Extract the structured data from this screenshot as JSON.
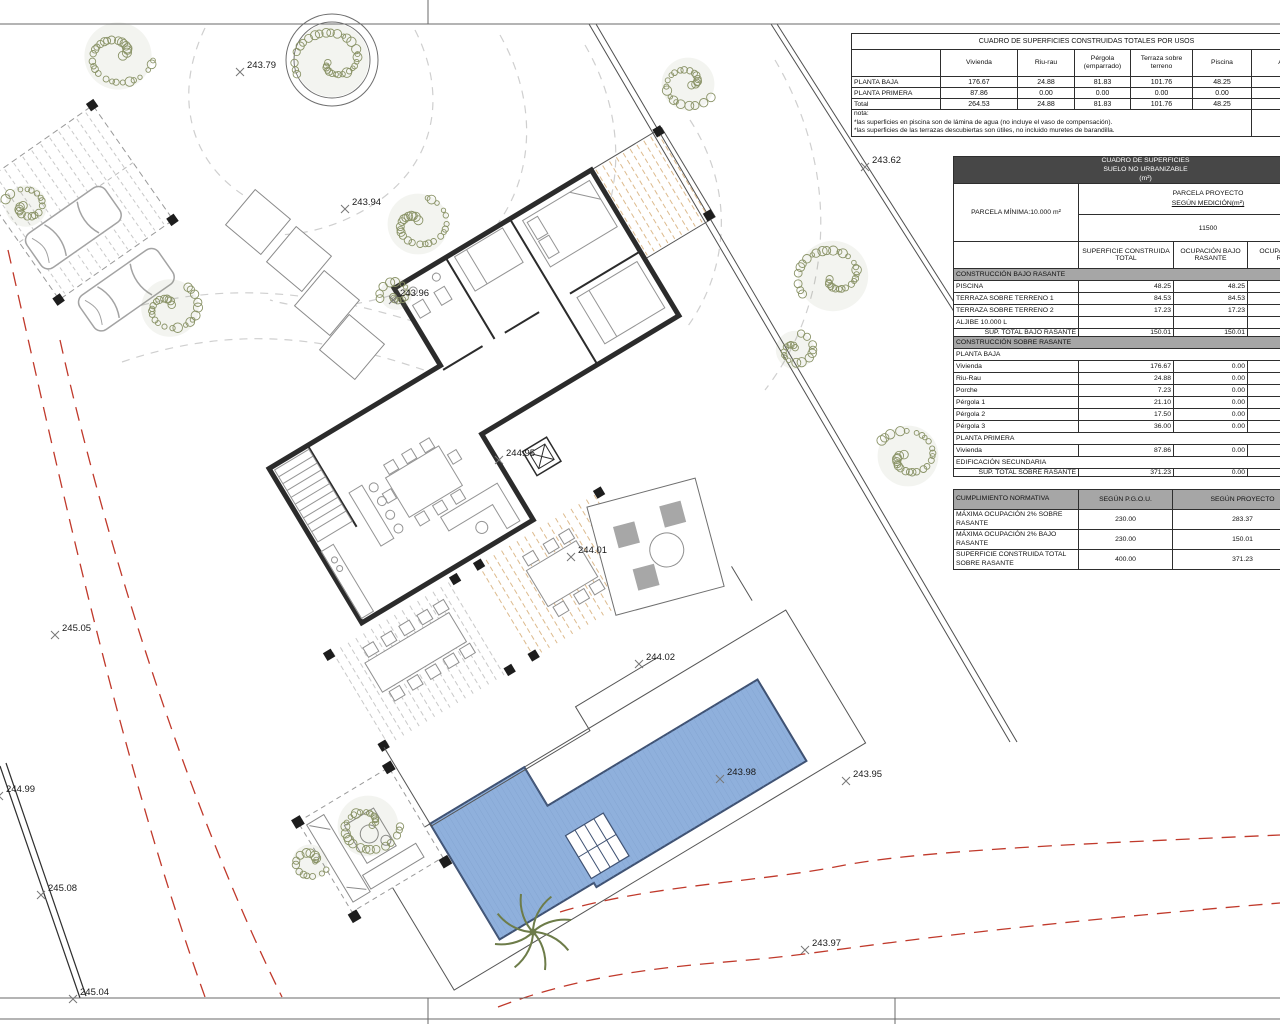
{
  "tables": {
    "usos": {
      "title": "CUADRO DE SUPERFICIES CONSTRUIDAS TOTALES POR USOS",
      "columns": [
        "",
        "Vivienda",
        "Riu-rau",
        "Pérgola (emparrado)",
        "Terraza sobre terreno",
        "Piscina",
        "Aljibe"
      ],
      "rows": [
        [
          "PLANTA BAJA",
          "176.67",
          "24.88",
          "81.83",
          "101.76",
          "48.25",
          "10"
        ],
        [
          "PLANTA PRIMERA",
          "87.86",
          "0.00",
          "0.00",
          "0.00",
          "0.00",
          "0."
        ],
        [
          "Total",
          "264.53",
          "24.88",
          "81.83",
          "101.76",
          "48.25",
          "10"
        ]
      ],
      "note_label": "nota:",
      "notes": [
        "*las superficies en piscina son de lámina de agua (no incluye el vaso de compensación).",
        "*las superficies de las terrazas descubiertas son útiles, no incluido muretes de barandilla."
      ]
    },
    "suelo": {
      "title_lines": [
        "CUADRO DE SUPERFICIES",
        "SUELO NO URBANIZABLE",
        "(m²)"
      ],
      "parcela_minima": "PARCELA MÍNIMA:10.000 m²",
      "parcela_proyecto_label": "PARCELA PROYECTO",
      "parcela_proyecto_sub": "SEGÚN MEDICIÓN(m²)",
      "parcela_value": "11500",
      "columns": [
        "",
        "SUPERFICIE CONSTRUIDA TOTAL",
        "OCUPACIÓN BAJO RASANTE",
        "OCUPACIÓN SOBRE RASANTE"
      ],
      "rows": [
        {
          "kind": "section",
          "label": "CONSTRUCCIÓN BAJO RASANTE"
        },
        {
          "kind": "data",
          "label": "PISCINA",
          "v1": "48.25",
          "v2": "48.25",
          "v3": ""
        },
        {
          "kind": "data",
          "label": "TERRAZA SOBRE TERRENO 1",
          "v1": "84.53",
          "v2": "84.53",
          "v3": ""
        },
        {
          "kind": "data",
          "label": "TERRAZA SOBRE TERRENO 2",
          "v1": "17.23",
          "v2": "17.23",
          "v3": ""
        },
        {
          "kind": "data",
          "label": "ALJIBE 10.000 L",
          "v1": "",
          "v2": "",
          "v3": ""
        },
        {
          "kind": "total",
          "label": "SUP. TOTAL BAJO RASANTE",
          "v1": "150.01",
          "v2": "150.01",
          "v3": ""
        },
        {
          "kind": "section",
          "label": "CONSTRUCCIÓN SOBRE RASANTE"
        },
        {
          "kind": "sub",
          "label": "PLANTA BAJA"
        },
        {
          "kind": "data",
          "label": "Vivienda",
          "v1": "176.67",
          "v2": "0.00",
          "v3": ""
        },
        {
          "kind": "data",
          "label": "Riu-Rau",
          "v1": "24.88",
          "v2": "0.00",
          "v3": ""
        },
        {
          "kind": "data",
          "label": "Porche",
          "v1": "7.23",
          "v2": "0.00",
          "v3": ""
        },
        {
          "kind": "data",
          "label": "Pérgola 1",
          "v1": "21.10",
          "v2": "0.00",
          "v3": ""
        },
        {
          "kind": "data",
          "label": "Pérgola 2",
          "v1": "17.50",
          "v2": "0.00",
          "v3": ""
        },
        {
          "kind": "data",
          "label": "Pérgola 3",
          "v1": "36.00",
          "v2": "0.00",
          "v3": ""
        },
        {
          "kind": "sub",
          "label": "PLANTA PRIMERA"
        },
        {
          "kind": "data",
          "label": "Vivienda",
          "v1": "87.86",
          "v2": "0.00",
          "v3": ""
        },
        {
          "kind": "sub",
          "label": "EDIFICACIÓN SECUNDARIA"
        },
        {
          "kind": "total",
          "label": "SUP. TOTAL SOBRE RASANTE",
          "v1": "371.23",
          "v2": "0.00",
          "v3": ""
        }
      ]
    },
    "normativa": {
      "columns": [
        "CUMPLIMIENTO NORMATIVA",
        "SEGÚN P.G.O.U.",
        "SEGÚN PROYECTO"
      ],
      "rows": [
        [
          "MÁXIMA OCUPACIÓN 2% SOBRE RASANTE",
          "230.00",
          "283.37"
        ],
        [
          "MÁXIMA OCUPACIÓN 2% BAJO RASANTE",
          "230.00",
          "150.01"
        ],
        [
          "SUPERFICIE CONSTRUIDA TOTAL SOBRE RASANTE",
          "400.00",
          "371.23"
        ]
      ]
    }
  },
  "plan": {
    "spot_elevations": [
      {
        "v": "243.79",
        "x": 247,
        "y": 68
      },
      {
        "v": "243.62",
        "x": 872,
        "y": 163
      },
      {
        "v": "243.94",
        "x": 352,
        "y": 205
      },
      {
        "v": "243.96",
        "x": 400,
        "y": 296
      },
      {
        "v": "244.95",
        "x": 506,
        "y": 456
      },
      {
        "v": "244.01",
        "x": 578,
        "y": 553
      },
      {
        "v": "244.02",
        "x": 646,
        "y": 660
      },
      {
        "v": "243.98",
        "x": 727,
        "y": 775
      },
      {
        "v": "243.95",
        "x": 853,
        "y": 777
      },
      {
        "v": "243.97",
        "x": 812,
        "y": 946
      },
      {
        "v": "245.05",
        "x": 62,
        "y": 631
      },
      {
        "v": "244.99",
        "x": 6,
        "y": 792
      },
      {
        "v": "245.08",
        "x": 48,
        "y": 891
      },
      {
        "v": "245.04",
        "x": 80,
        "y": 995
      }
    ],
    "trees": [
      {
        "x": 118,
        "y": 56,
        "r": 42
      },
      {
        "x": 26,
        "y": 206,
        "r": 26
      },
      {
        "x": 332,
        "y": 60,
        "r": 46,
        "ring": true
      },
      {
        "x": 418,
        "y": 224,
        "r": 38
      },
      {
        "x": 170,
        "y": 308,
        "r": 36
      },
      {
        "x": 396,
        "y": 294,
        "r": 20
      },
      {
        "x": 688,
        "y": 84,
        "r": 33
      },
      {
        "x": 833,
        "y": 276,
        "r": 44
      },
      {
        "x": 795,
        "y": 350,
        "r": 24
      },
      {
        "x": 908,
        "y": 456,
        "r": 38
      },
      {
        "x": 368,
        "y": 826,
        "r": 38
      },
      {
        "x": 310,
        "y": 862,
        "r": 22
      }
    ],
    "colors": {
      "pool_fill": "#8fb0dc",
      "pool_stroke": "#3f5273",
      "pool_hatch": "#7b9bc8",
      "tree": "#8a9367",
      "contour": "#cfcfcf",
      "boundary_red": "#c0392b",
      "wall": "#2b2b2b",
      "hatch_tan": "#ddbb8e",
      "hatch_gray": "#c9c9c9",
      "furniture": "#949494"
    }
  }
}
